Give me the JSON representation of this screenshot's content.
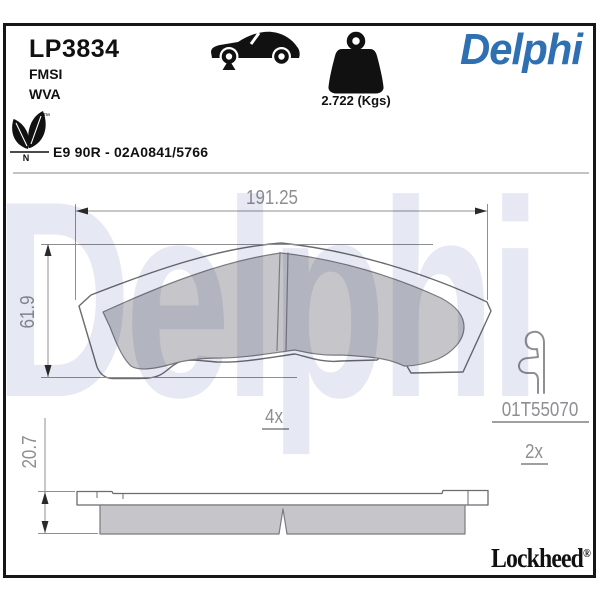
{
  "header": {
    "part_number": "LP3834",
    "line2": "FMSI",
    "line3": "WVA",
    "brand": "Delphi",
    "weight": "2.722 (Kgs)",
    "homologation": "E9 90R - 02A0841/5766",
    "eco": {
      "letter": "N",
      "tm": "™"
    }
  },
  "drawing": {
    "width_mm": "191.25",
    "height_mm": "61.9",
    "thickness_mm": "20.7",
    "pad_count": "4x",
    "accessory": {
      "ref": "01T55070",
      "count": "2x"
    }
  },
  "watermark": "Delphi",
  "footer": {
    "brand": "Lockheed",
    "reg": "®"
  },
  "icons": {
    "car": "car-side-icon",
    "weight": "weight-icon",
    "leaf": "eco-leaf-icon"
  },
  "colors": {
    "brand_blue": "#2e70b2",
    "friction_gray": "#c6c6ca",
    "outline_gray": "#6b6b70",
    "dimension_gray": "#8f8f93",
    "watermark_tint": "#e6e9f3"
  }
}
